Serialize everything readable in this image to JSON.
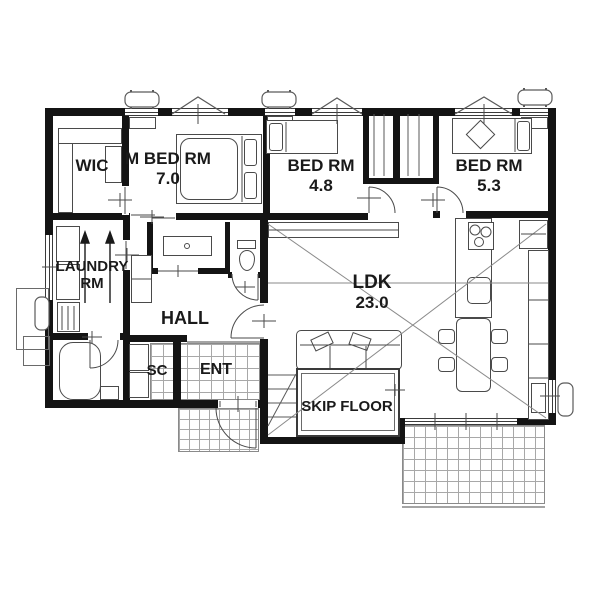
{
  "title": "single-story house floor plan",
  "colors": {
    "background": "#ffffff",
    "wall": "#141414",
    "furniture_line": "#4a4a4a",
    "tile_line": "#a8a8a8",
    "text": "#1a1a1a"
  },
  "rooms": {
    "wic": {
      "name": "WIC"
    },
    "m_bed": {
      "name": "M BED RM",
      "area": "7.0"
    },
    "bed_1": {
      "name": "BED RM",
      "area": "4.8"
    },
    "bed_2": {
      "name": "BED RM",
      "area": "5.3"
    },
    "laundry": {
      "name": "LAUNDRY\nRM"
    },
    "hall": {
      "name": "HALL"
    },
    "sc": {
      "name": "SC"
    },
    "ent": {
      "name": "ENT"
    },
    "ldk": {
      "name": "LDK",
      "area": "23.0"
    },
    "skip_floor": {
      "name": "SKIP FLOOR"
    }
  },
  "icons": {
    "ac_outdoor_unit": "rounded-rect with feet",
    "gable_window": "triangle over window",
    "laundry_pole_arrows": "two up arrows",
    "void_cross": "X diagonals over LDK"
  }
}
